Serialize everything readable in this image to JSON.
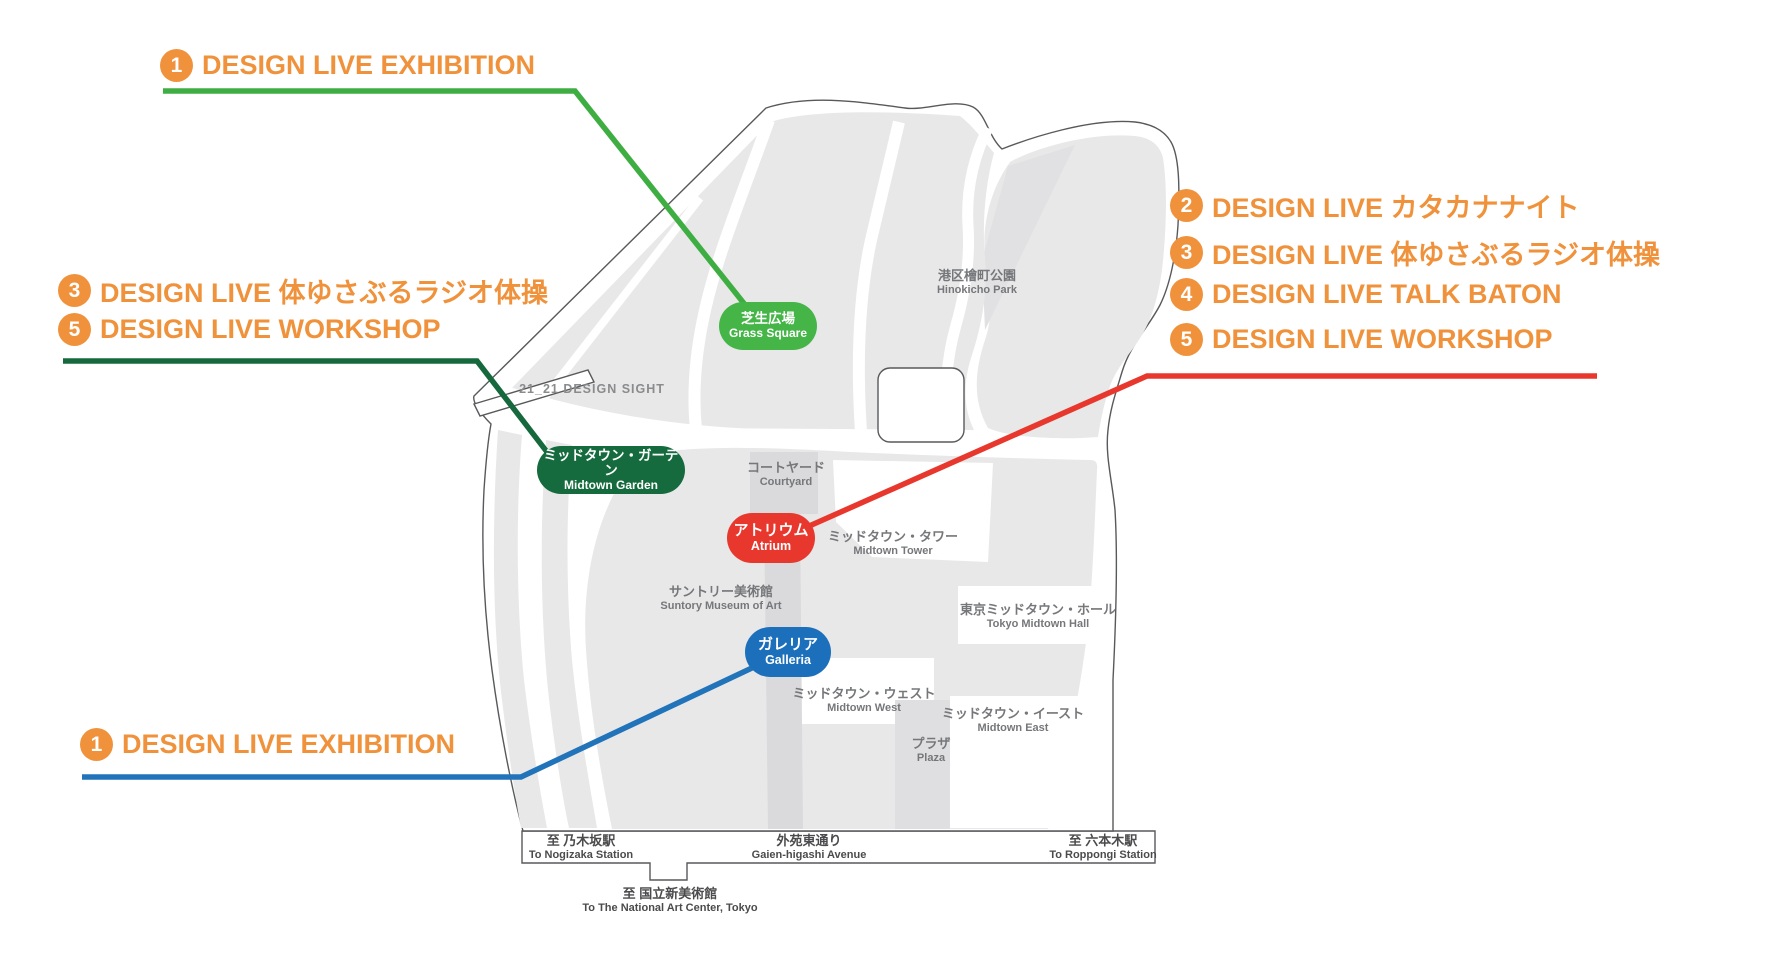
{
  "title": "Tokyo Midtown DESIGN LIVE venue map",
  "colors": {
    "accent_orange": "#F0923B",
    "line_green": "#3FAE42",
    "line_dark_green": "#16683D",
    "line_red": "#E8382D",
    "line_blue": "#2173BA",
    "pill_grass_square": "#45B548",
    "pill_midtown_garden": "#156B3E",
    "pill_atrium": "#E8382D",
    "pill_galleria": "#1C6FBA",
    "map_gray": "#e8e8e9"
  },
  "legend": {
    "top_left": {
      "number": "1",
      "label": "DESIGN LIVE EXHIBITION"
    },
    "mid_left": [
      {
        "number": "3",
        "label": "DESIGN LIVE 体ゆさぶるラジオ体操"
      },
      {
        "number": "5",
        "label": "DESIGN LIVE WORKSHOP"
      }
    ],
    "right": [
      {
        "number": "2",
        "label": "DESIGN LIVE カタカナナイト"
      },
      {
        "number": "3",
        "label": "DESIGN LIVE 体ゆさぶるラジオ体操"
      },
      {
        "number": "4",
        "label": "DESIGN LIVE TALK BATON"
      },
      {
        "number": "5",
        "label": "DESIGN LIVE WORKSHOP"
      }
    ],
    "bottom_left": {
      "number": "1",
      "label": "DESIGN LIVE EXHIBITION"
    }
  },
  "venues": {
    "grass_square": {
      "jp": "芝生広場",
      "en": "Grass Square"
    },
    "midtown_garden": {
      "jp": "ミッドタウン・ガーデン",
      "en": "Midtown Garden"
    },
    "atrium": {
      "jp": "アトリウム",
      "en": "Atrium"
    },
    "galleria": {
      "jp": "ガレリア",
      "en": "Galleria"
    }
  },
  "map_labels": {
    "hinokicho_park": {
      "jp": "港区檜町公園",
      "en": "Hinokicho Park"
    },
    "design_sight": {
      "jp": "21_21 DESIGN SIGHT"
    },
    "courtyard": {
      "jp": "コートヤード",
      "en": "Courtyard"
    },
    "midtown_tower": {
      "jp": "ミッドタウン・タワー",
      "en": "Midtown Tower"
    },
    "suntory_museum": {
      "jp": "サントリー美術館",
      "en": "Suntory Museum of Art"
    },
    "midtown_hall": {
      "jp": "東京ミッドタウン・ホール",
      "en": "Tokyo Midtown Hall"
    },
    "midtown_west": {
      "jp": "ミッドタウン・ウェスト",
      "en": "Midtown West"
    },
    "midtown_east": {
      "jp": "ミッドタウン・イースト",
      "en": "Midtown East"
    },
    "plaza": {
      "jp": "プラザ",
      "en": "Plaza"
    }
  },
  "road_labels": {
    "nogizaka": {
      "jp": "至 乃木坂駅",
      "en": "To Nogizaka Station"
    },
    "gaien_higashi": {
      "jp": "外苑東通り",
      "en": "Gaien-higashi Avenue"
    },
    "roppongi": {
      "jp": "至 六本木駅",
      "en": "To Roppongi Station"
    },
    "national_art_center": {
      "jp": "至 国立新美術館",
      "en": "To The National Art Center, Tokyo"
    }
  }
}
